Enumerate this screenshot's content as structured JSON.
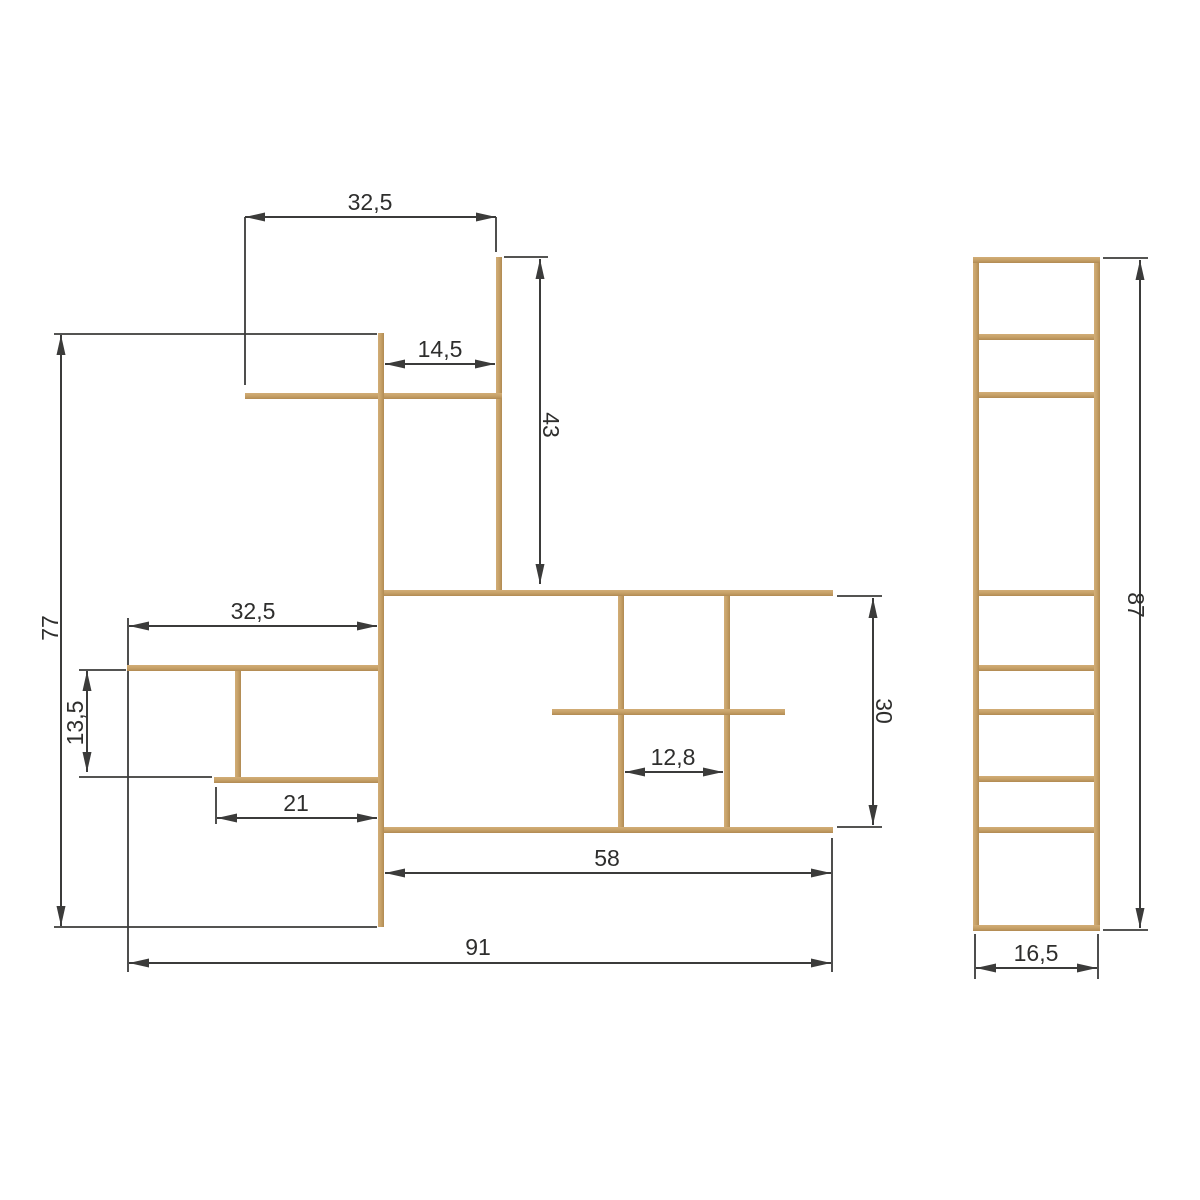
{
  "canvas": {
    "width": 1200,
    "height": 1200,
    "background": "#ffffff"
  },
  "style": {
    "wood_color": "#c6a167",
    "wood_light": "#d2ad77",
    "wood_dark": "#b18a52",
    "line_color": "#3b3b3a",
    "text_color": "#2e2e2d",
    "font_size": 23,
    "dim_line_width": 2,
    "ext_line_width": 1.8,
    "arrow_length": 20,
    "arrow_width": 9
  },
  "front_view": {
    "name": "shelf-front-view",
    "pieces": [
      {
        "name": "upper-post",
        "x": 496,
        "y": 257,
        "w": 6,
        "h": 336
      },
      {
        "name": "upper-shelf",
        "x": 245,
        "y": 393,
        "w": 257,
        "h": 6
      },
      {
        "name": "main-post",
        "x": 378,
        "y": 333,
        "w": 6,
        "h": 594
      },
      {
        "name": "mid-top-shelf",
        "x": 384,
        "y": 590,
        "w": 449,
        "h": 6
      },
      {
        "name": "mid-bottom-shelf",
        "x": 384,
        "y": 827,
        "w": 449,
        "h": 6
      },
      {
        "name": "mid-divider-left",
        "x": 618,
        "y": 596,
        "w": 6,
        "h": 231
      },
      {
        "name": "mid-divider-right",
        "x": 724,
        "y": 596,
        "w": 6,
        "h": 231
      },
      {
        "name": "mid-inner-shelf",
        "x": 552,
        "y": 709,
        "w": 233,
        "h": 6
      },
      {
        "name": "left-upper-shelf",
        "x": 127,
        "y": 665,
        "w": 251,
        "h": 6
      },
      {
        "name": "left-divider",
        "x": 235,
        "y": 671,
        "w": 6,
        "h": 106
      },
      {
        "name": "left-lower-shelf",
        "x": 214,
        "y": 777,
        "w": 164,
        "h": 6
      }
    ]
  },
  "side_view": {
    "name": "shelf-side-view",
    "pieces": [
      {
        "name": "side-left-rail",
        "x": 973,
        "y": 257,
        "w": 6,
        "h": 674
      },
      {
        "name": "side-right-rail",
        "x": 1094,
        "y": 257,
        "w": 6,
        "h": 674
      },
      {
        "name": "side-rung-top",
        "x": 973,
        "y": 257,
        "w": 127,
        "h": 6
      },
      {
        "name": "side-rung-2",
        "x": 979,
        "y": 334,
        "w": 115,
        "h": 6
      },
      {
        "name": "side-rung-3",
        "x": 979,
        "y": 392,
        "w": 115,
        "h": 6
      },
      {
        "name": "side-rung-4",
        "x": 979,
        "y": 590,
        "w": 115,
        "h": 6
      },
      {
        "name": "side-rung-5",
        "x": 979,
        "y": 665,
        "w": 115,
        "h": 6
      },
      {
        "name": "side-rung-6",
        "x": 979,
        "y": 709,
        "w": 115,
        "h": 6
      },
      {
        "name": "side-rung-7",
        "x": 979,
        "y": 776,
        "w": 115,
        "h": 6
      },
      {
        "name": "side-rung-8",
        "x": 979,
        "y": 827,
        "w": 115,
        "h": 6
      },
      {
        "name": "side-rung-bottom",
        "x": 973,
        "y": 925,
        "w": 127,
        "h": 6
      }
    ]
  },
  "dimensions": [
    {
      "id": "upper-shelf-width",
      "value": "32,5",
      "line": {
        "x1": 245,
        "y1": 217,
        "x2": 496,
        "y2": 217
      },
      "label": {
        "x": 370,
        "y": 210,
        "rotate": 0
      },
      "extensions": [
        {
          "x1": 245,
          "y1": 217,
          "x2": 245,
          "y2": 385
        },
        {
          "x1": 496,
          "y1": 217,
          "x2": 496,
          "y2": 252
        }
      ]
    },
    {
      "id": "upper-inset-width",
      "value": "14,5",
      "line": {
        "x1": 385,
        "y1": 364,
        "x2": 495,
        "y2": 364
      },
      "label": {
        "x": 440,
        "y": 357,
        "rotate": 0
      },
      "extensions": []
    },
    {
      "id": "upper-post-height",
      "value": "43",
      "line": {
        "x1": 540,
        "y1": 259,
        "x2": 540,
        "y2": 584
      },
      "label": {
        "x": 543,
        "y": 425,
        "rotate": 90
      },
      "extensions": [
        {
          "x1": 504,
          "y1": 257,
          "x2": 548,
          "y2": 257
        }
      ]
    },
    {
      "id": "overall-height",
      "value": "77",
      "line": {
        "x1": 61,
        "y1": 335,
        "x2": 61,
        "y2": 926
      },
      "label": {
        "x": 58,
        "y": 628,
        "rotate": -90
      },
      "extensions": [
        {
          "x1": 54,
          "y1": 334,
          "x2": 377,
          "y2": 334
        },
        {
          "x1": 54,
          "y1": 927,
          "x2": 377,
          "y2": 927
        }
      ]
    },
    {
      "id": "left-shelf-width",
      "value": "32,5",
      "line": {
        "x1": 129,
        "y1": 626,
        "x2": 377,
        "y2": 626
      },
      "label": {
        "x": 253,
        "y": 619,
        "rotate": 0
      },
      "extensions": [
        {
          "x1": 128,
          "y1": 618,
          "x2": 128,
          "y2": 972
        }
      ]
    },
    {
      "id": "left-cubby-height",
      "value": "13,5",
      "line": {
        "x1": 87,
        "y1": 671,
        "x2": 87,
        "y2": 772
      },
      "label": {
        "x": 83,
        "y": 723,
        "rotate": -90
      },
      "extensions": [
        {
          "x1": 79,
          "y1": 670,
          "x2": 126,
          "y2": 670
        },
        {
          "x1": 79,
          "y1": 777,
          "x2": 212,
          "y2": 777
        }
      ]
    },
    {
      "id": "left-lower-shelf-width",
      "value": "21",
      "line": {
        "x1": 217,
        "y1": 818,
        "x2": 377,
        "y2": 818
      },
      "label": {
        "x": 296,
        "y": 811,
        "rotate": 0
      },
      "extensions": [
        {
          "x1": 216,
          "y1": 787,
          "x2": 216,
          "y2": 824
        }
      ]
    },
    {
      "id": "mid-section-height",
      "value": "30",
      "line": {
        "x1": 873,
        "y1": 598,
        "x2": 873,
        "y2": 825
      },
      "label": {
        "x": 876,
        "y": 711,
        "rotate": 90
      },
      "extensions": [
        {
          "x1": 837,
          "y1": 596,
          "x2": 882,
          "y2": 596
        },
        {
          "x1": 837,
          "y1": 827,
          "x2": 882,
          "y2": 827
        }
      ]
    },
    {
      "id": "mid-cubby-width",
      "value": "12,8",
      "line": {
        "x1": 625,
        "y1": 772,
        "x2": 723,
        "y2": 772
      },
      "label": {
        "x": 673,
        "y": 765,
        "rotate": 0
      },
      "extensions": []
    },
    {
      "id": "mid-section-width",
      "value": "58",
      "line": {
        "x1": 385,
        "y1": 873,
        "x2": 831,
        "y2": 873
      },
      "label": {
        "x": 607,
        "y": 866,
        "rotate": 0
      },
      "extensions": [
        {
          "x1": 832,
          "y1": 838,
          "x2": 832,
          "y2": 972
        }
      ]
    },
    {
      "id": "overall-width",
      "value": "91",
      "line": {
        "x1": 129,
        "y1": 963,
        "x2": 831,
        "y2": 963
      },
      "label": {
        "x": 478,
        "y": 955,
        "rotate": 0
      },
      "extensions": []
    },
    {
      "id": "side-height",
      "value": "87",
      "line": {
        "x1": 1140,
        "y1": 260,
        "x2": 1140,
        "y2": 928
      },
      "label": {
        "x": 1128,
        "y": 605,
        "rotate": 90
      },
      "extensions": [
        {
          "x1": 1103,
          "y1": 258,
          "x2": 1148,
          "y2": 258
        },
        {
          "x1": 1103,
          "y1": 930,
          "x2": 1148,
          "y2": 930
        }
      ]
    },
    {
      "id": "side-depth",
      "value": "16,5",
      "line": {
        "x1": 976,
        "y1": 968,
        "x2": 1097,
        "y2": 968
      },
      "label": {
        "x": 1036,
        "y": 961,
        "rotate": 0
      },
      "extensions": [
        {
          "x1": 975,
          "y1": 934,
          "x2": 975,
          "y2": 979
        },
        {
          "x1": 1098,
          "y1": 934,
          "x2": 1098,
          "y2": 979
        }
      ]
    }
  ]
}
